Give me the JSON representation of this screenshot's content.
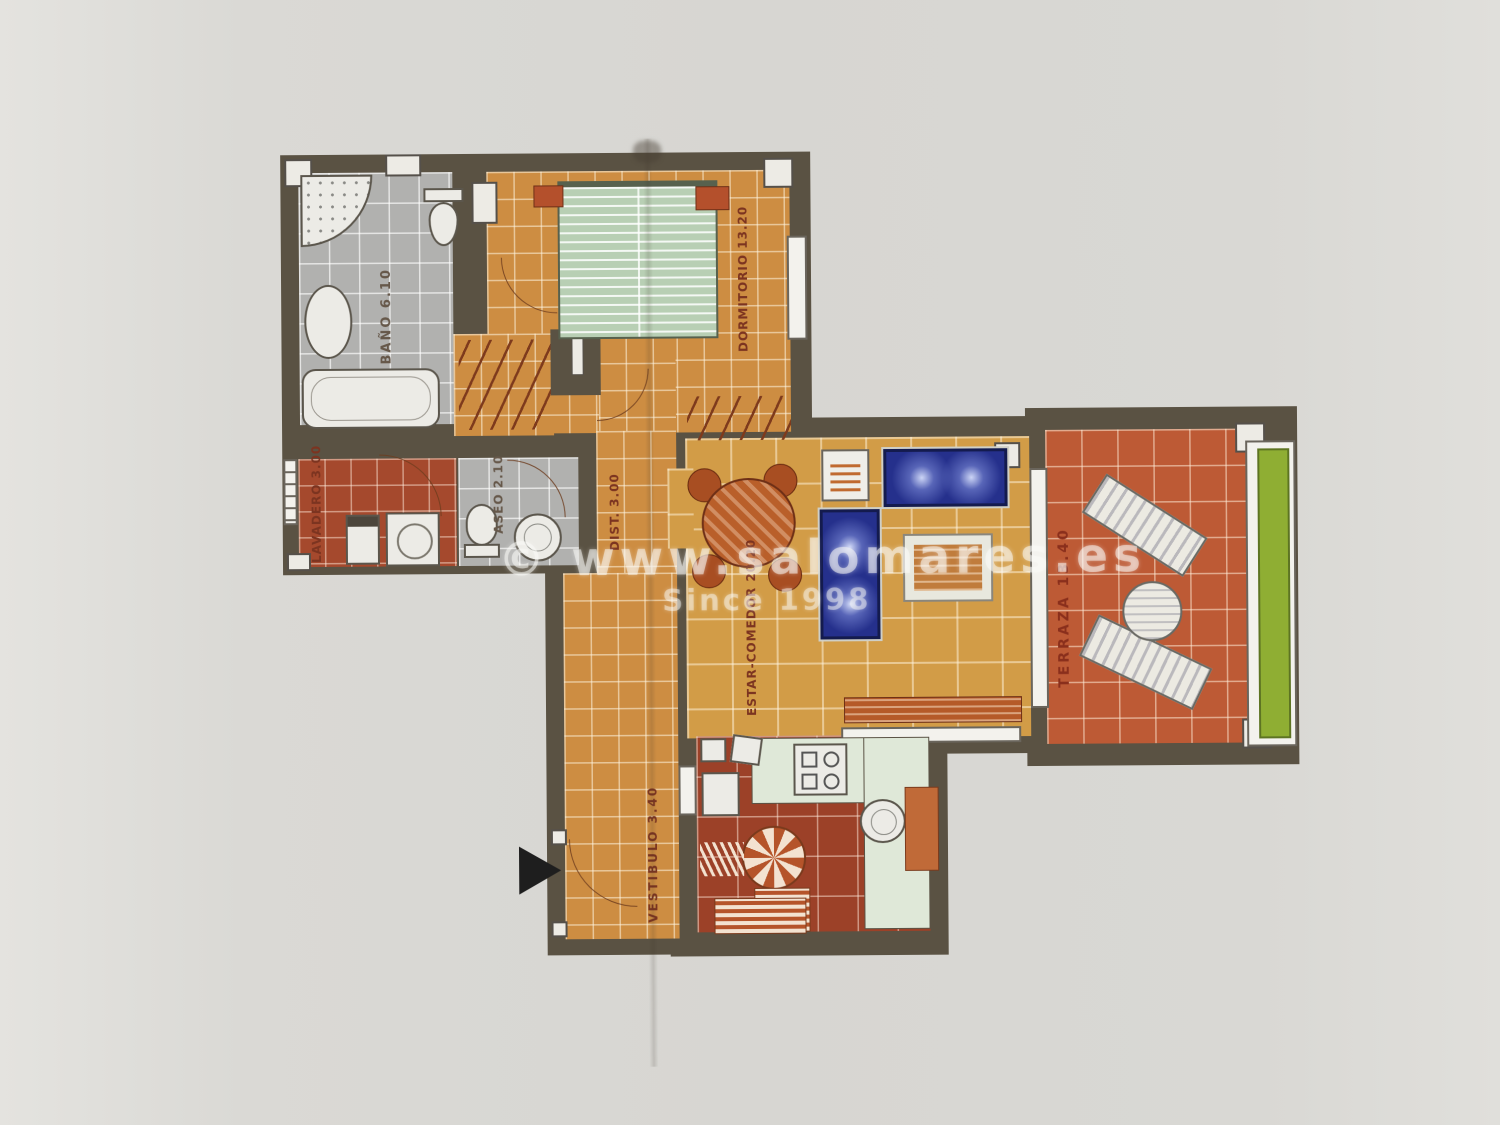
{
  "watermark": {
    "line1": "© www.salomares.es",
    "line2": "Since 1998"
  },
  "rooms": [
    {
      "name": "BAÑO",
      "area": "6.10",
      "label": "BAÑO 6.10"
    },
    {
      "name": "DORMITORIO",
      "area": "13.20",
      "label": "DORMITORIO 13.20"
    },
    {
      "name": "LAVADERO",
      "area": "3.00",
      "label": "LAVADERO 3.00"
    },
    {
      "name": "ASEO",
      "area": "2.10",
      "label": "ASEO 2.10"
    },
    {
      "name": "DIST.",
      "area": "3.00",
      "label": "DIST. 3.00"
    },
    {
      "name": "ESTAR-COMEDOR",
      "area": "20.20",
      "label": "ESTAR-COMEDOR 20.20"
    },
    {
      "name": "TERRAZA",
      "area": "13.40",
      "label": "TERRAZA 13.40"
    },
    {
      "name": "VESTIBULO",
      "area": "3.40",
      "label": "VESTIBULO 3.40"
    }
  ],
  "icons": {
    "entrance_arrow": "black right-pointing triangle marking the entrance door"
  },
  "colors": {
    "wall": "#5a5243",
    "bedroom_floor": "#cd8d42",
    "living_floor": "#d29c47",
    "bath_floor": "#b1b1af",
    "laundry_floor": "#a5492d",
    "terrace_floor": "#bd5a35",
    "kitchen_floor": "#9c4128",
    "sofa": "#25308c",
    "bed": "#b8cfb4",
    "planter": "#8fae33",
    "label_text": "#7c3420",
    "background": "#d7d6d2"
  }
}
